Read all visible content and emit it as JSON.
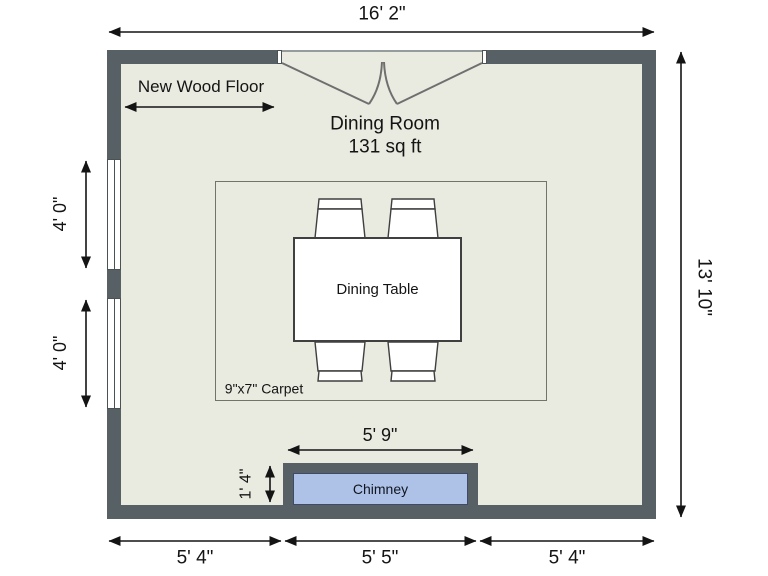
{
  "plan": {
    "room_name": "Dining Room",
    "room_area": "131 sq ft",
    "floor_note": "New Wood Floor",
    "table_label": "Dining Table",
    "carpet_label": "9\"x7\" Carpet",
    "chimney_label": "Chimney"
  },
  "dimensions": {
    "width_total": "16' 2\"",
    "height_total": "13' 10\"",
    "window_upper": "4' 0\"",
    "window_lower": "4' 0\"",
    "bottom_left": "5' 4\"",
    "bottom_center": "5' 5\"",
    "bottom_right": "5' 4\"",
    "chimney_width": "5' 9\"",
    "chimney_depth": "1' 4\""
  },
  "colors": {
    "wall": "#576064",
    "floor": "#e9ebe0",
    "chimney_fill": "#aec2e8",
    "dimension": "#141414",
    "background": "#ffffff"
  }
}
